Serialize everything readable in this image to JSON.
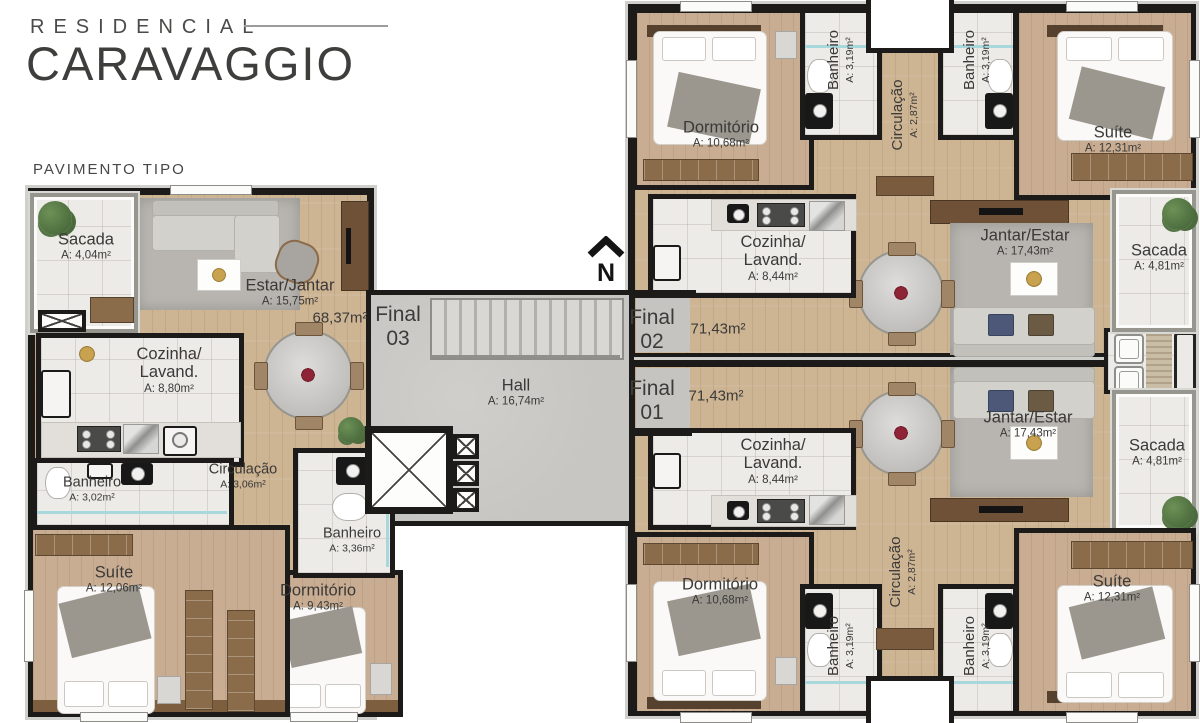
{
  "brand": {
    "line1": "RESIDENCIAL",
    "line2": "CARAVAGGIO"
  },
  "plan_title": "PAVIMENTO TIPO",
  "north_label": "N",
  "hall": {
    "name": "Hall",
    "area": "A: 16,74m²"
  },
  "units": {
    "f03": {
      "label_line1": "Final",
      "label_line2": "03",
      "total_area": "68,37m²"
    },
    "f02": {
      "label_line1": "Final",
      "label_line2": "02",
      "total_area": "71,43m²"
    },
    "f01": {
      "label_line1": "Final",
      "label_line2": "01",
      "total_area": "71,43m²"
    }
  },
  "f03": {
    "sacada": {
      "name": "Sacada",
      "area": "A: 4,04m²"
    },
    "estar": {
      "name": "Estar/Jantar",
      "area": "A: 15,75m²"
    },
    "cozinha": {
      "name": "Cozinha/\nLavand.",
      "area": "A: 8,80m²"
    },
    "banheiro1": {
      "name": "Banheiro",
      "area": "A: 3,02m²"
    },
    "circulacao": {
      "name": "Circulação",
      "area": "A: 3,06m²"
    },
    "banheiro2": {
      "name": "Banheiro",
      "area": "A: 3,36m²"
    },
    "suite": {
      "name": "Suíte",
      "area": "A: 12,06m²"
    },
    "dormitorio": {
      "name": "Dormitório",
      "area": "A: 9,43m²"
    }
  },
  "f02": {
    "dormitorio": {
      "name": "Dormitório",
      "area": "A: 10,68m²"
    },
    "banheiro_esq": {
      "name": "Banheiro",
      "area": "A: 3,19m²"
    },
    "circulacao": {
      "name": "Circulação",
      "area": "A: 2,87m²"
    },
    "banheiro_dir": {
      "name": "Banheiro",
      "area": "A: 3,19m²"
    },
    "suite": {
      "name": "Suíte",
      "area": "A: 12,31m²"
    },
    "cozinha": {
      "name": "Cozinha/\nLavand.",
      "area": "A: 8,44m²"
    },
    "jantar": {
      "name": "Jantar/Estar",
      "area": "A: 17,43m²"
    },
    "sacada": {
      "name": "Sacada",
      "area": "A: 4,81m²"
    }
  },
  "f01": {
    "dormitorio": {
      "name": "Dormitório",
      "area": "A: 10,68m²"
    },
    "banheiro_esq": {
      "name": "Banheiro",
      "area": "A: 3,19m²"
    },
    "circulacao": {
      "name": "Circulação",
      "area": "A: 2,87m²"
    },
    "banheiro_dir": {
      "name": "Banheiro",
      "area": "A: 3,19m²"
    },
    "suite": {
      "name": "Suíte",
      "area": "A: 12,31m²"
    },
    "cozinha": {
      "name": "Cozinha/\nLavand.",
      "area": "A: 8,44m²"
    },
    "jantar": {
      "name": "Jantar/Estar",
      "area": "A: 17,43m²"
    },
    "sacada": {
      "name": "Sacada",
      "area": "A: 4,81m²"
    }
  },
  "colors": {
    "wall": "#1d1b19",
    "wood_floor": "#cdb493",
    "bedroom_floor": "#c9ad93",
    "tile_floor": "#edebe7",
    "concrete_floor": "#c7c6c2",
    "rug": "#b8b5b1",
    "accent_wood": "#8a6b4a"
  }
}
